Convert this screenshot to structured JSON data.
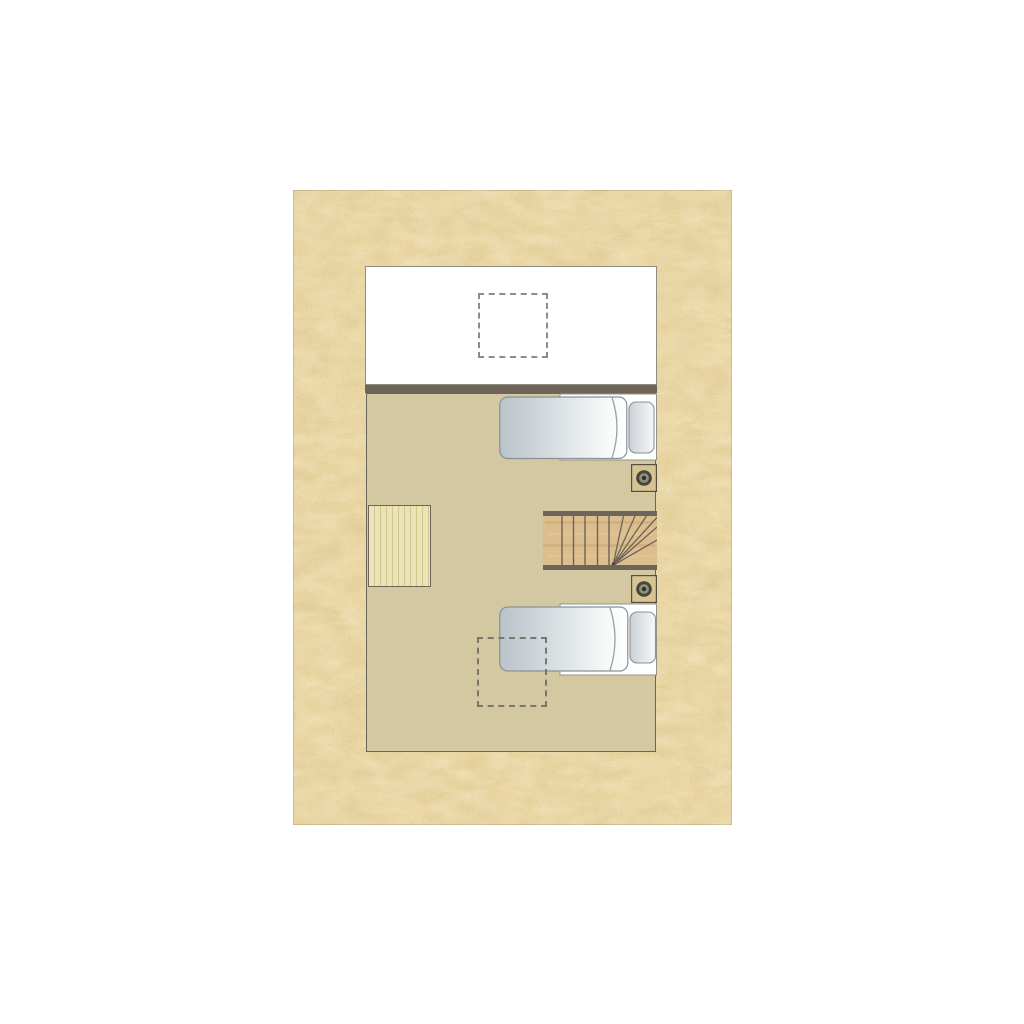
{
  "meta": {
    "description": "Architectural floor plan of an upper storey: white void room with dashed roof-window, tan sleeping loft with two single beds, winder staircase, side table, two spotlight symbols and a second dashed roof-window outline, all on a speckled sand-coloured backdrop.",
    "visible_text": []
  },
  "colors": {
    "page_bg": "#ffffff",
    "sand_base": "#eed9a3",
    "sand_speckle_dark": "#8c703d",
    "sand_edge": "#7d6f4e",
    "room_upper_bg": "#ffffff",
    "room_upper_border": "#8d8d84",
    "wall": "#6e6458",
    "floor": "#d3c8a1",
    "floor_border": "#6b6557",
    "dashed_upper": "#8c8c8c",
    "dashed_lower": "#77776e",
    "table_wood": "#eae4b6",
    "table_border": "#6d6759",
    "stair_wood": "#dcbd8e",
    "stair_rail": "#6c665a",
    "stair_line": "#6b6459",
    "bed_base_fill": "#ffffff",
    "bed_base_stroke": "#93938b",
    "mattress_dark": "#b9c3ca",
    "mattress_mid": "#dde3e6",
    "mattress_light": "#ffffff",
    "mattress_stroke": "#8a9197",
    "fold_line": "#9aa1a6",
    "pillow_dark": "#c9d1d6",
    "pillow_light": "#f7f8f9",
    "fixture_square": "#d8c395",
    "fixture_border": "#57503f",
    "fixture_ring_outer": "#45453e",
    "fixture_ring_inner": "#8f9078",
    "fixture_dot": "#30302a"
  },
  "plan": {
    "elements": [
      {
        "name": "upper-room",
        "type": "room",
        "floor": "white"
      },
      {
        "name": "roof-window-upper",
        "type": "dashed-opening"
      },
      {
        "name": "dividing-wall",
        "type": "wall"
      },
      {
        "name": "lower-room",
        "type": "room",
        "floor": "tan"
      },
      {
        "name": "side-table",
        "type": "table",
        "material": "pale wood"
      },
      {
        "name": "winder-staircase",
        "type": "stairs",
        "straight_treads": 5,
        "winder_treads": 6,
        "turn": "right"
      },
      {
        "name": "single-bed-top",
        "type": "bed",
        "pillow_side": "right"
      },
      {
        "name": "single-bed-bottom",
        "type": "bed",
        "pillow_side": "right"
      },
      {
        "name": "spotlight-top",
        "type": "light-fixture"
      },
      {
        "name": "spotlight-bottom",
        "type": "light-fixture"
      },
      {
        "name": "roof-window-lower",
        "type": "dashed-opening"
      }
    ]
  }
}
